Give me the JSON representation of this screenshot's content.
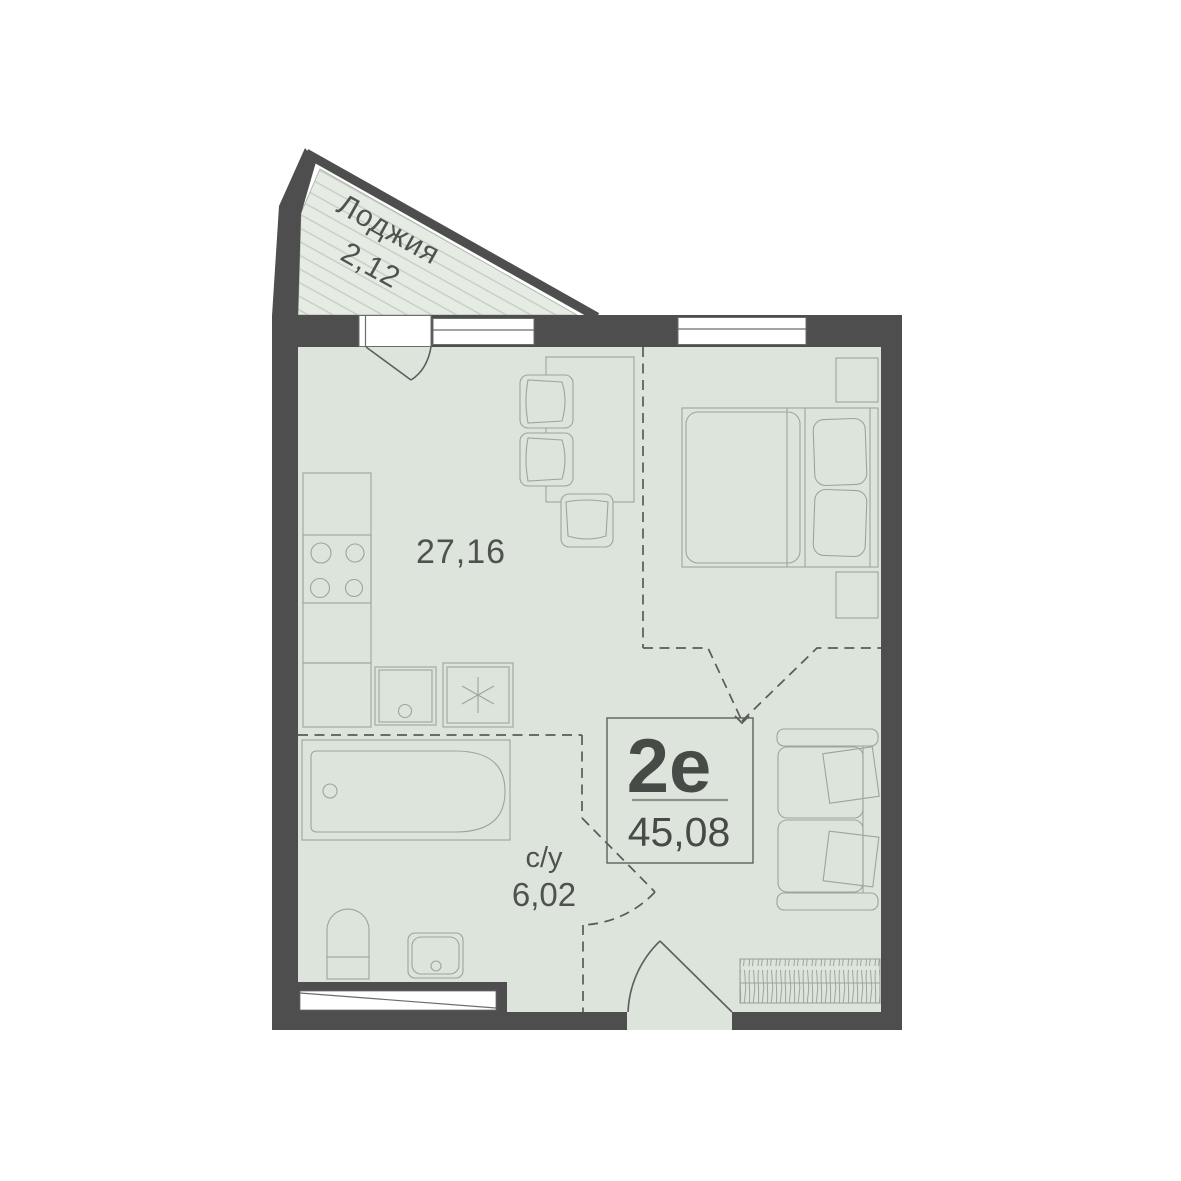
{
  "plan": {
    "title": "apartment-floorplan",
    "loggia": {
      "label": "Лоджия",
      "area": "2,12"
    },
    "main_room": {
      "area": "27,16"
    },
    "bathroom": {
      "label": "с/у",
      "area": "6,02"
    },
    "info_badge": {
      "unit_type": "2е",
      "total_area": "45,08"
    }
  },
  "colors": {
    "wall": "#4e4e4e",
    "floor": "#dde4dc",
    "loggia_fill": "#e6ebe4",
    "furniture_line": "#9aa69c",
    "dash_line": "#585c58",
    "text": "#4f534f",
    "hatch": "#c3cfc3"
  }
}
